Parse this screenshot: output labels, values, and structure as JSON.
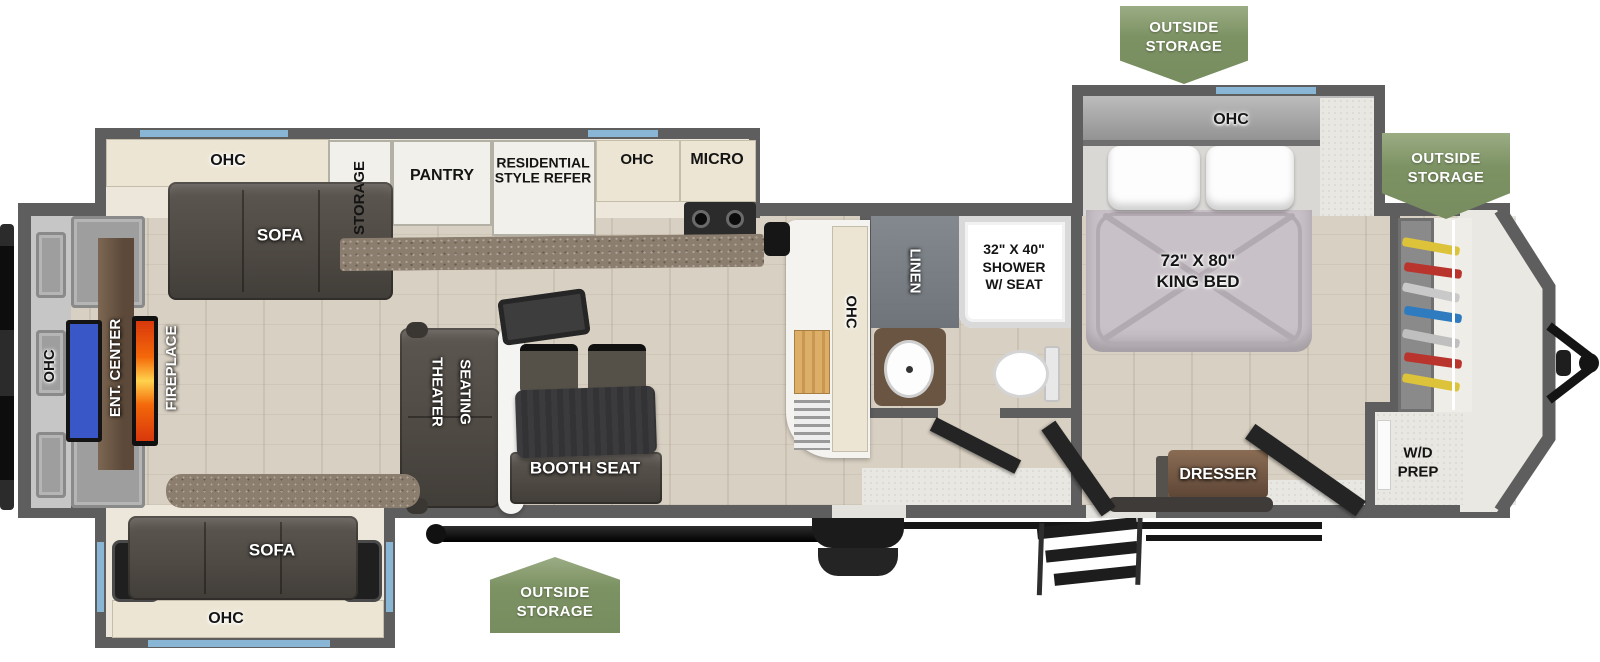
{
  "badges": {
    "line1": "OUTSIDE",
    "line2": "STORAGE"
  },
  "rooms": {
    "kitchen_slide": {
      "ohc": "OHC",
      "sofa": "SOFA",
      "storage": "STORAGE",
      "pantry": "PANTRY",
      "refer_line1": "RESIDENTIAL",
      "refer_line2": "STYLE REFER",
      "galley_ohc": "OHC",
      "micro": "MICRO"
    },
    "counter": {
      "ohc": "OHC"
    },
    "bath": {
      "linen": "LINEN",
      "shower_line1": "32\" X 40\"",
      "shower_line2": "SHOWER",
      "shower_line3": "W/ SEAT"
    },
    "bedroom": {
      "slide_ohc": "OHC",
      "bed_line1": "72\" X 80\"",
      "bed_line2": "KING BED",
      "dresser": "DRESSER",
      "wd_line1": "W/D",
      "wd_line2": "PREP"
    },
    "rear": {
      "ohc": "OHC",
      "ent_center": "ENT. CENTER",
      "fireplace": "FIREPLACE"
    },
    "living": {
      "theater_line1": "THEATER",
      "theater_line2": "SEATING",
      "booth": "BOOTH SEAT"
    },
    "rear_slide": {
      "sofa": "SOFA",
      "ohc": "OHC"
    }
  },
  "colors": {
    "badge_green": "#7c9263",
    "wall_gray": "#5e5e5e",
    "window_blue": "#8ab6d6",
    "tv_blue": "#3a57c8",
    "fireplace_orange": "#ff7a00",
    "floor_tan": "#d8d0c2",
    "sofa_brown": "#4f4a44"
  }
}
